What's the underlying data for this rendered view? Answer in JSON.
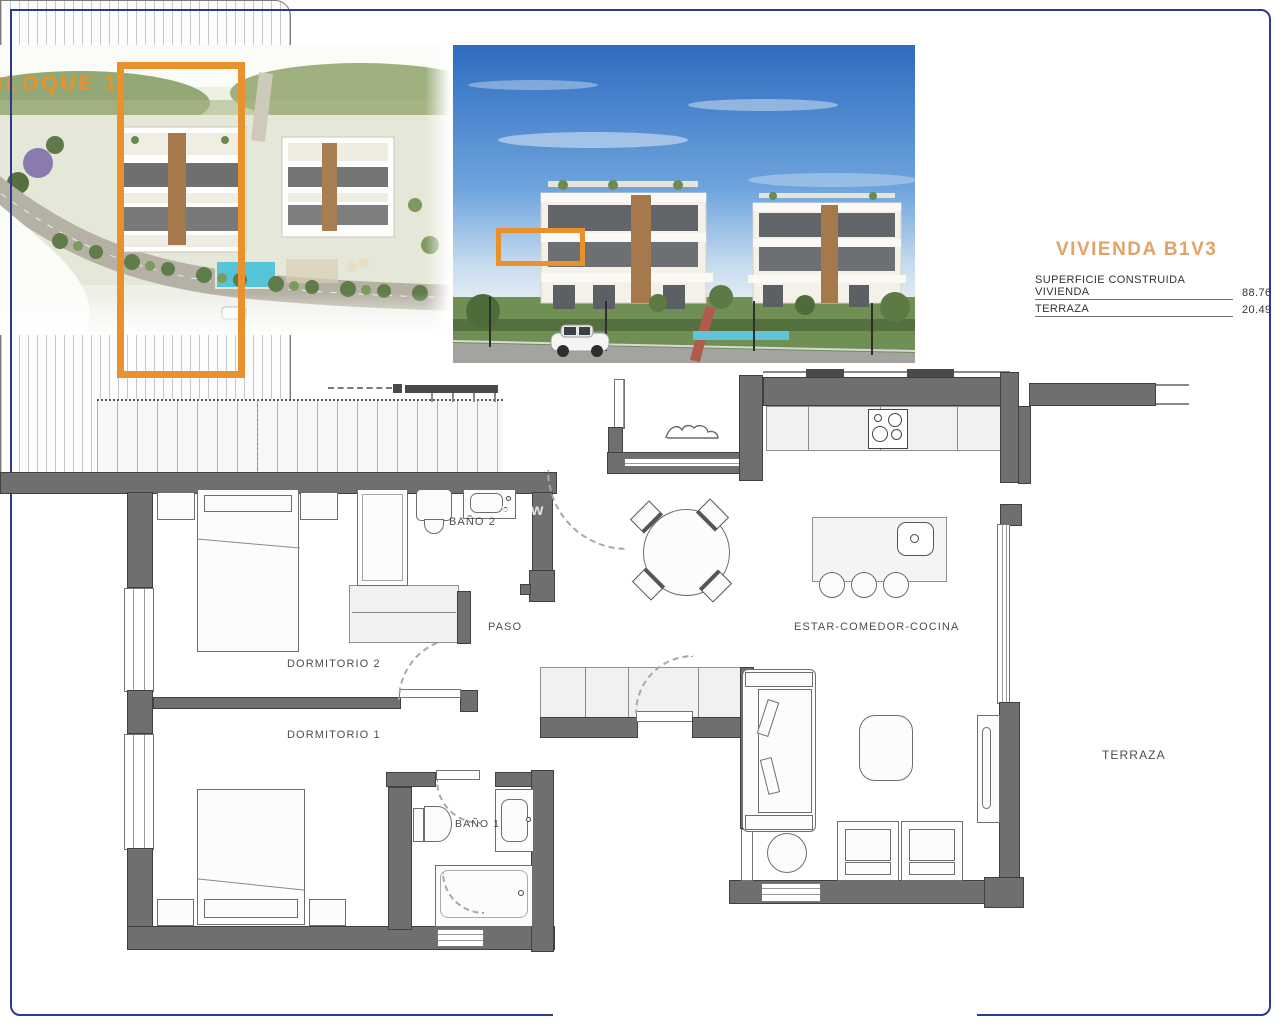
{
  "overview": {
    "block_label": "BLOQUE 1"
  },
  "unit": {
    "title": "VIVIENDA B1V3",
    "areas": [
      {
        "label": "SUPERFICIE CONSTRUIDA VIVIENDA",
        "value": "88.76"
      },
      {
        "label": "TERRAZA",
        "value": "20.49"
      }
    ]
  },
  "floorplan": {
    "labels": {
      "bano2": "BAÑO 2",
      "paso": "PASO",
      "dormitorio2": "DORMITORIO 2",
      "dormitorio1": "DORMITORIO 1",
      "bano1": "BAÑO 1",
      "estar_comedor_cocina": "ESTAR-COMEDOR-COCINA",
      "terraza": "TERRAZA"
    }
  },
  "watermark_text": "www",
  "colors": {
    "accent_orange": "#E8912D",
    "unit_title_tan": "#E3A365",
    "terrace_line_navy": "#2B3990",
    "wall_gray": "#6F6F6F",
    "pool_blue": "#55C3D8"
  }
}
